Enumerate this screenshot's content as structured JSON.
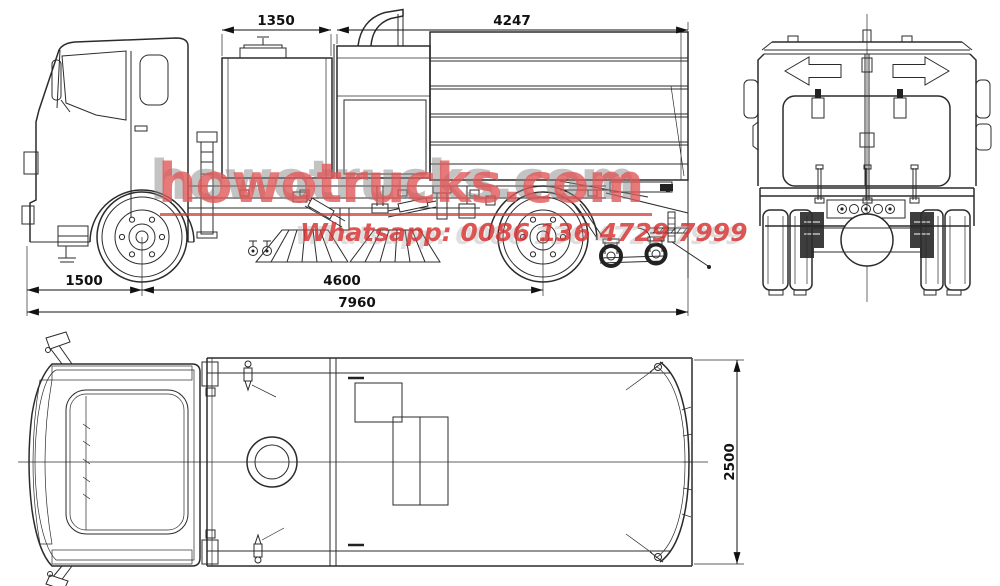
{
  "watermark": {
    "brand_text": "howotrucks.com",
    "contact_text": "Whatsapp: 0086 136 4729 7999",
    "brand_color": "#e05858",
    "shadow_color": "#878787",
    "underline_color": "#d23c3c"
  },
  "drawing": {
    "line_color": "#2b2b2b",
    "background_color": "#ffffff"
  },
  "dimensions": {
    "front_tank_length": "1350",
    "rear_body_length": "4247",
    "front_overhang": "1500",
    "wheelbase": "4600",
    "overall_length": "7960",
    "overall_width": "2500"
  },
  "icons": {
    "rear_left_arrow": "left-arrow-icon",
    "rear_right_arrow": "right-arrow-icon"
  }
}
